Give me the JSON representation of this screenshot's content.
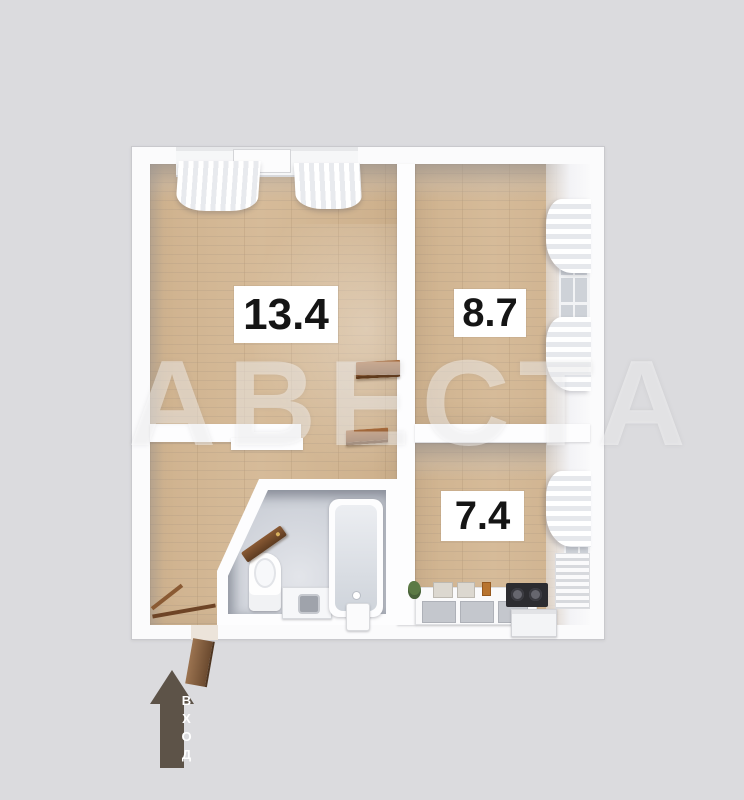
{
  "floorplan": {
    "watermark": "АВЕСТА",
    "rooms": [
      {
        "id": "living",
        "area_label": "13.4"
      },
      {
        "id": "bedroom",
        "area_label": "8.7"
      },
      {
        "id": "kitchen",
        "area_label": "7.4"
      }
    ],
    "entrance": {
      "label": "ВХОД"
    },
    "colors": {
      "background": "#dbdbde",
      "wall": "#fdfdfe",
      "wood_floor": "#d2b694",
      "bath_floor": "#ced2d9",
      "arrow_brown": "#5d5348",
      "door_brown": "#7c4a24",
      "label_text": "#151515"
    }
  }
}
